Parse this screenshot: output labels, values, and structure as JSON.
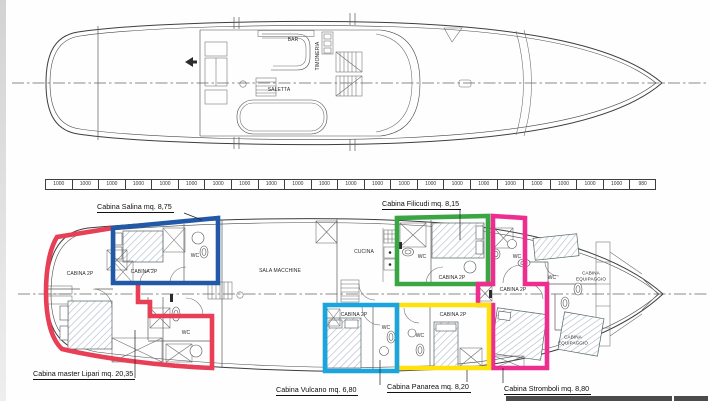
{
  "palette": {
    "ink": "#3e3e3e",
    "salina_blue": "#2159a8",
    "filicudi_green": "#3aa543",
    "lipari_red": "#e83e56",
    "vulcano_cyan": "#1ba5e0",
    "panarea_yellow": "#ffe20c",
    "stromboli_magenta": "#ed2d90"
  },
  "upper_deck": {
    "bar_label": "BAR",
    "timoneria_label": "TIMONERIA",
    "saletta_label": "SALETTA"
  },
  "scale_bar": {
    "segments": [
      "1000",
      "1000",
      "1000",
      "1000",
      "1000",
      "1000",
      "1000",
      "1000",
      "1000",
      "1000",
      "1000",
      "1000",
      "1000",
      "1000",
      "1000",
      "1000",
      "1000",
      "1000",
      "1000",
      "1000",
      "1000",
      "1000",
      "980"
    ]
  },
  "lower_deck": {
    "room_labels": {
      "cabina_2p": "CABINA 2P",
      "wc": "WC",
      "cucina": "CUCINA",
      "sala_macchine": "SALA MACCHINE",
      "cabina_equipaggio": "CABINA EQUIPAGGIO"
    }
  },
  "cabins": [
    {
      "id": "salina",
      "label": "Cabina Salina mq. 8,75",
      "color": "#2159a8"
    },
    {
      "id": "filicudi",
      "label": "Cabina Filicudi mq. 8,15",
      "color": "#3aa543"
    },
    {
      "id": "lipari",
      "label": "Cabina master Lipari mq. 20,35",
      "color": "#e83e56"
    },
    {
      "id": "vulcano",
      "label": "Cabina Vulcano mq. 6,80",
      "color": "#1ba5e0"
    },
    {
      "id": "panarea",
      "label": "Cabina Panarea mq. 8,20",
      "color": "#ffe20c"
    },
    {
      "id": "stromboli",
      "label": "Cabina Stromboli mq. 8,80",
      "color": "#ed2d90"
    }
  ]
}
